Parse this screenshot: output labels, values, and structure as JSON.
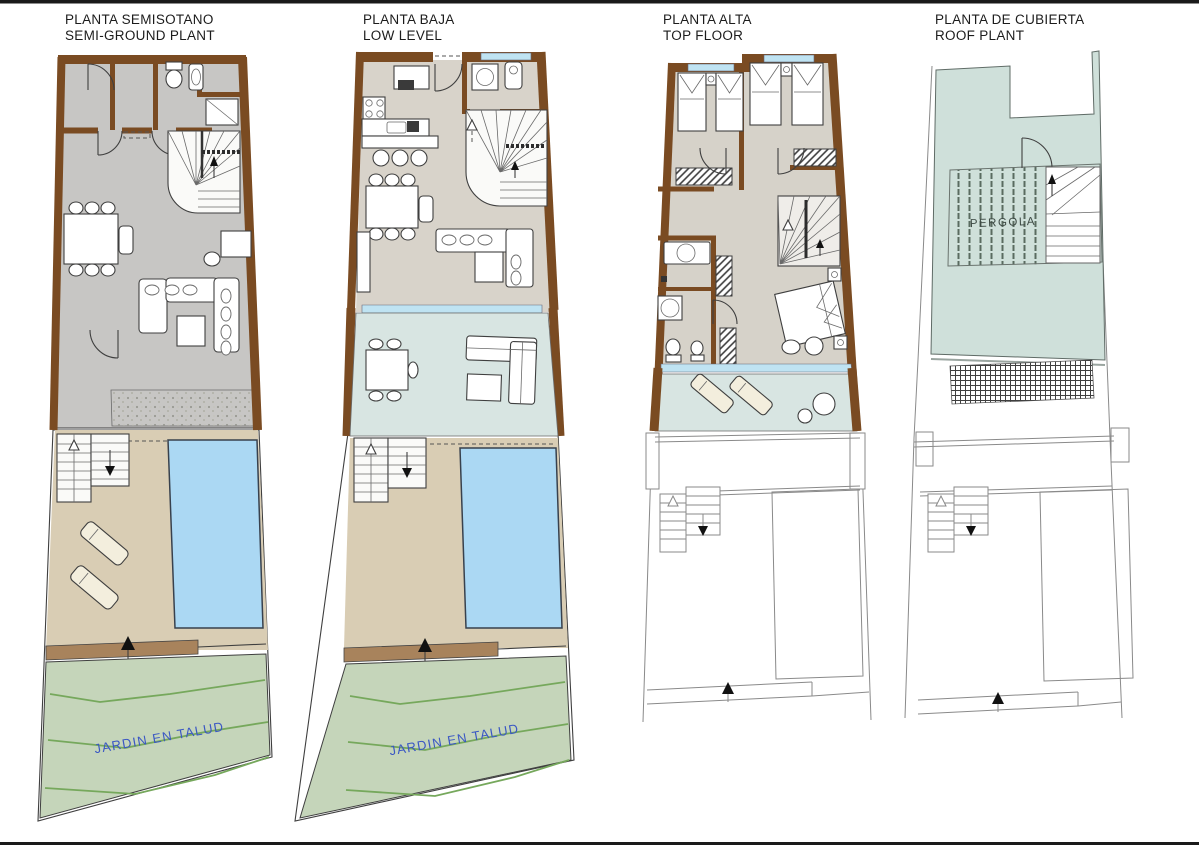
{
  "page": {
    "type": "architectural floor plan sheet",
    "background": "#ffffff"
  },
  "palette": {
    "wall_brown": "#7a4b22",
    "earth_brown": "#a8835c",
    "floor_semi_gray": "#c7c6c4",
    "floor_main_beige": "#d8d3ca",
    "floor_top_beige": "#d6d2c9",
    "tile_teal": "#d8e5e2",
    "tile_grid": "#7fa3a6",
    "glass_blue": "#bfe3f2",
    "pool_blue": "#abd8f3",
    "terrace_sand": "#d9cdb4",
    "garden_green": "#c5d5ba",
    "contour_green": "#76a85c",
    "roof_teal": "#cfe0da",
    "label_blue": "#3a57c4",
    "ink": "#3f3f3f"
  },
  "plans": [
    {
      "id": "semi-ground",
      "title_line1": "PLANTA SEMISOTANO",
      "title_line2": "SEMI-GROUND PLANT",
      "garden_label": "JARDIN EN TALUD"
    },
    {
      "id": "low-level",
      "title_line1": "PLANTA BAJA",
      "title_line2": "LOW LEVEL",
      "garden_label": "JARDIN EN TALUD"
    },
    {
      "id": "top-floor",
      "title_line1": "PLANTA ALTA",
      "title_line2": "TOP FLOOR"
    },
    {
      "id": "roof",
      "title_line1": "PLANTA DE CUBIERTA",
      "title_line2": "ROOF PLANT",
      "pergola_label": "PERGOLA"
    }
  ]
}
